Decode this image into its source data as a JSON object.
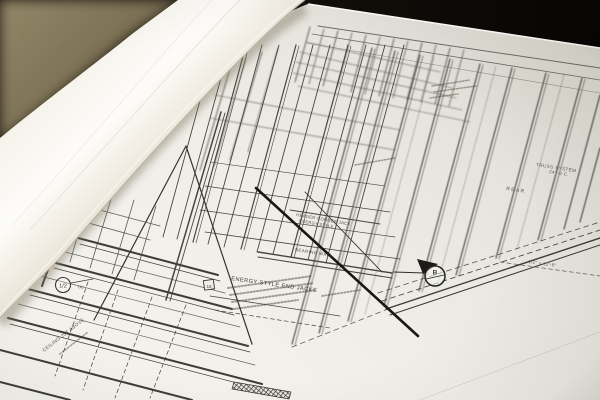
{
  "scene": {
    "description": "Photograph of architectural blueprints: a curled rolled page on the left over an angled wood-framing floor plan sheet, dark room background at top",
    "colors": {
      "background_dark": "#0d0c0a",
      "table_tan": "#8e8163",
      "paper_white": "#f1efe9",
      "ink": "#3c3b38"
    }
  },
  "labels": {
    "truss_system": "TRUSS SYSTEM",
    "truss_spacing": "24\" O.C.",
    "rear": "REAR",
    "header_jack_1": "HEADER CORNER JACK",
    "header_jack_2": "ENERGY STYLE",
    "bearing_wall": "BEARING WALL",
    "end_jacks": "ENERGY STYLE END JACKS",
    "ceiling_joist": "CEILING JST ABOVE",
    "beam_note": "1/2\" x 12'-6\"",
    "section_letter": "B",
    "keynote": "15",
    "detail_value": "1/2",
    "detail_suffix": "OC"
  }
}
